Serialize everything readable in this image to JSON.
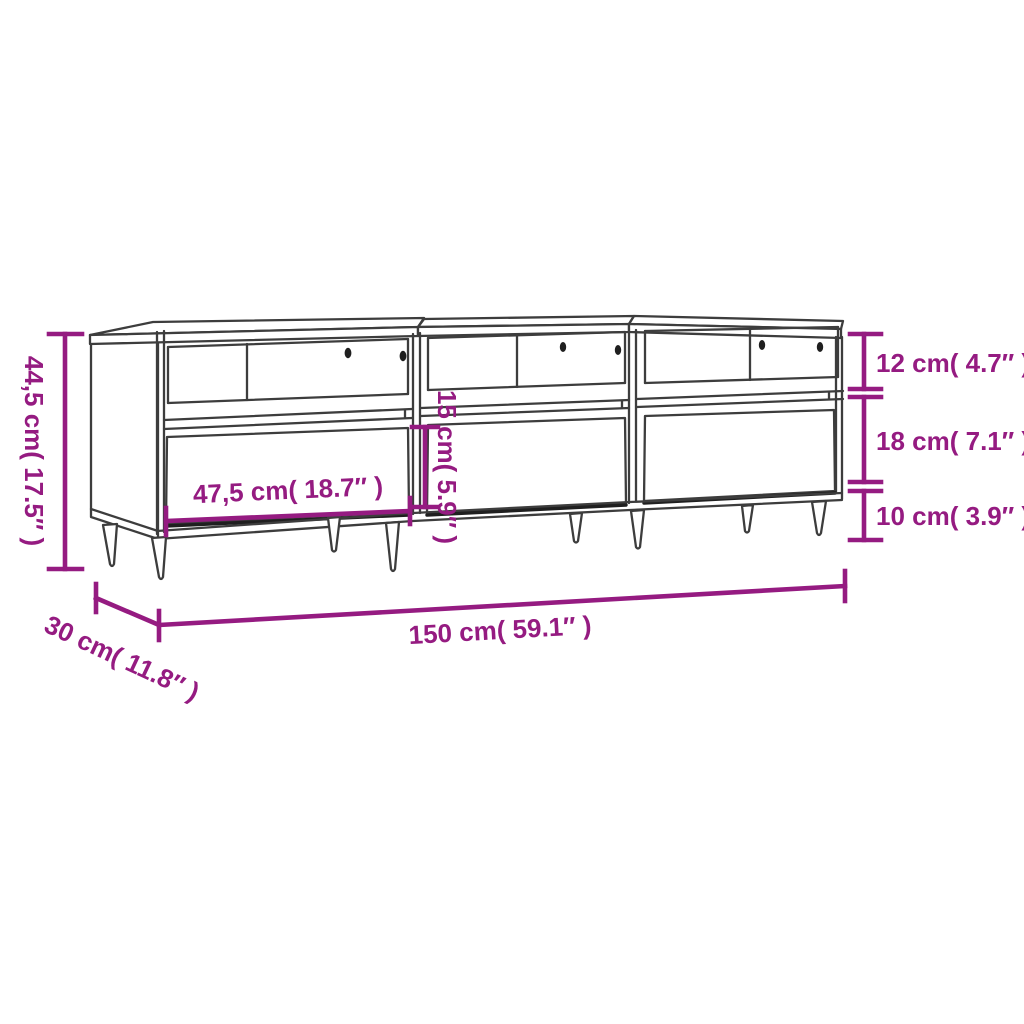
{
  "colors": {
    "dimension": "#951b81",
    "line": "#3d3d3d",
    "hole": "#1f1f1f",
    "background": "#ffffff"
  },
  "dimensions": {
    "overall_height": "44,5 cm( 17.5″ )",
    "overall_width": "150 cm( 59.1″ )",
    "overall_depth": "30 cm( 11.8″ )",
    "open_shelf_height": "12 cm( 4.7″ )",
    "middle_section_height": "18 cm( 7.1″ )",
    "leg_height": "10 cm( 3.9″ )",
    "drawer_inner_height": "15 cm( 5.9″ )",
    "drawer_width": "47,5 cm( 18.7″ )"
  }
}
